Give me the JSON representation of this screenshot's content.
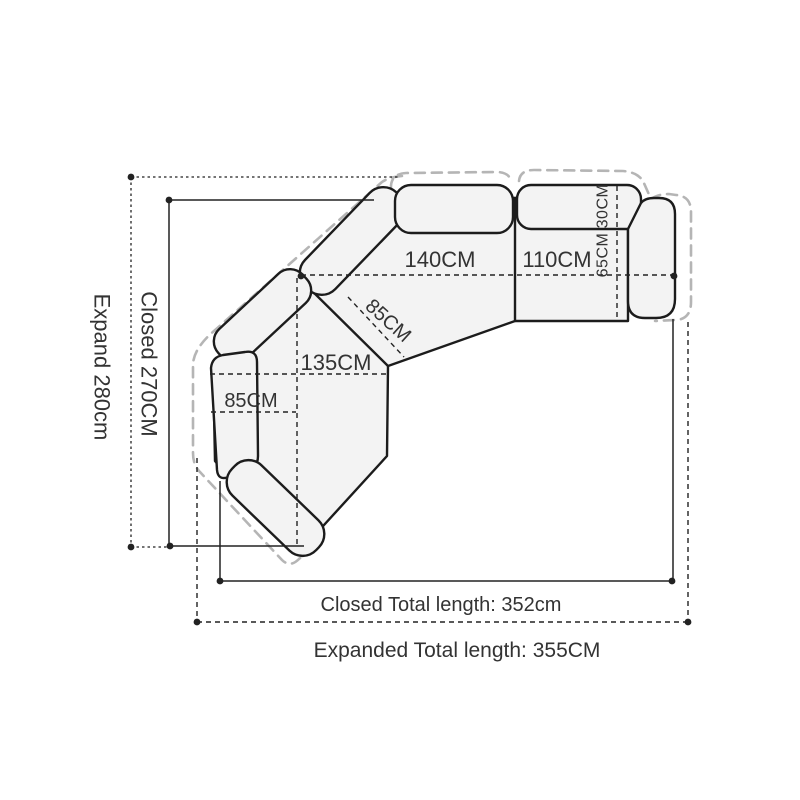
{
  "diagram_title": "sectional-sofa-dimension-drawing",
  "colors": {
    "sofa-outline": "#1c1c1c",
    "sofa-fill": "#f3f3f3",
    "expanded-outline": "#b5b5b5",
    "dimension-line": "#222222",
    "label-text": "#333333",
    "page-bg": "#ffffff"
  },
  "labels": {
    "module_140": "140CM",
    "module_110": "110CM",
    "backrest_depth": "30CM",
    "seat_depth": "65CM",
    "chaise_length": "135CM",
    "chaise_width": "85CM",
    "corner_seat_width": "85CM",
    "expand_depth": "Expand 280cm",
    "closed_depth": "Closed 270CM",
    "closed_total": "Closed Total length: 352cm",
    "expanded_total": "Expanded Total length: 355CM"
  },
  "measurements": {
    "module_140_cm": 140,
    "module_110_cm": 110,
    "backrest_depth_cm": 30,
    "seat_depth_cm": 65,
    "chaise_length_cm": 135,
    "chaise_width_cm": 85,
    "corner_seat_width_cm": 85,
    "expand_depth_cm": 280,
    "closed_depth_cm": 270,
    "closed_total_length_cm": 352,
    "expanded_total_length_cm": 355
  }
}
